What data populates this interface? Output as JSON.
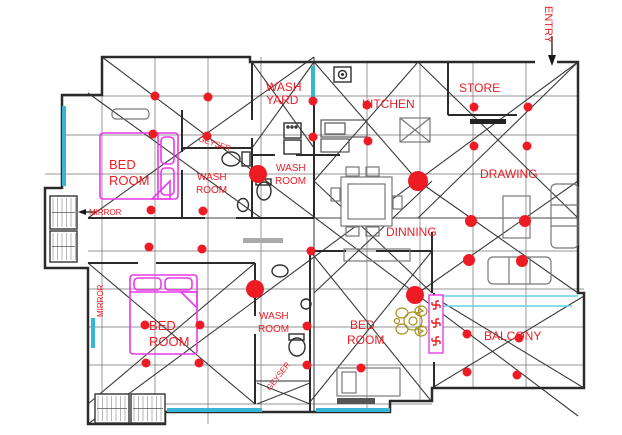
{
  "canvas": {
    "width": 622,
    "height": 435,
    "background": "#ffffff"
  },
  "colors": {
    "label": "#ed1c24",
    "dot": "#ed1c24",
    "wall": "#2b2b2b",
    "grid": "#707070",
    "diagonal": "#3a3a3a",
    "window": "#35b6d6",
    "bed": "#e93ae9",
    "furniture": "#777777",
    "fixture": "#2f2f2f",
    "ornament": "#a8921f",
    "swastika": "#ed1c24",
    "swastika_box": "#e93ae9"
  },
  "labels": [
    {
      "id": "entry",
      "text": "ENTRY",
      "x": 545,
      "y": 6,
      "size": 11,
      "rotate": 90
    },
    {
      "id": "wash-yard-1",
      "text": "WASH",
      "x": 266,
      "y": 91,
      "size": 12,
      "rotate": 0
    },
    {
      "id": "wash-yard-2",
      "text": "YARD",
      "x": 266,
      "y": 104,
      "size": 12,
      "rotate": 0
    },
    {
      "id": "kitchen",
      "text": "KITCHEN",
      "x": 362,
      "y": 108,
      "size": 12,
      "rotate": 0
    },
    {
      "id": "store",
      "text": "STORE",
      "x": 459,
      "y": 92,
      "size": 12,
      "rotate": 0
    },
    {
      "id": "drawing",
      "text": "DRAWING",
      "x": 480,
      "y": 178,
      "size": 12,
      "rotate": 0
    },
    {
      "id": "dinning",
      "text": "DINNING",
      "x": 386,
      "y": 236,
      "size": 12,
      "rotate": 0
    },
    {
      "id": "balcony",
      "text": "BALCONY",
      "x": 484,
      "y": 340,
      "size": 12,
      "rotate": 0
    },
    {
      "id": "bed-room-1a",
      "text": "BED",
      "x": 109,
      "y": 169,
      "size": 13,
      "rotate": 0
    },
    {
      "id": "bed-room-1b",
      "text": "ROOM",
      "x": 109,
      "y": 185,
      "size": 13,
      "rotate": 0
    },
    {
      "id": "bed-room-2a",
      "text": "BED",
      "x": 149,
      "y": 330,
      "size": 13,
      "rotate": 0
    },
    {
      "id": "bed-room-2b",
      "text": "ROOM",
      "x": 149,
      "y": 346,
      "size": 13,
      "rotate": 0
    },
    {
      "id": "bed-room-3a",
      "text": "BED",
      "x": 350,
      "y": 329,
      "size": 12,
      "rotate": 0
    },
    {
      "id": "bed-room-3b",
      "text": "ROOM",
      "x": 347,
      "y": 344,
      "size": 12,
      "rotate": 0
    },
    {
      "id": "wash-room-1a",
      "text": "WASH",
      "x": 197,
      "y": 180,
      "size": 10,
      "rotate": 0
    },
    {
      "id": "wash-room-1b",
      "text": "ROOM",
      "x": 196,
      "y": 193,
      "size": 10,
      "rotate": 0
    },
    {
      "id": "wash-room-2a",
      "text": "WASH",
      "x": 276,
      "y": 171,
      "size": 10,
      "rotate": 0
    },
    {
      "id": "wash-room-2b",
      "text": "ROOM",
      "x": 275,
      "y": 184,
      "size": 10,
      "rotate": 0
    },
    {
      "id": "wash-room-3a",
      "text": "WASH",
      "x": 259,
      "y": 319,
      "size": 10,
      "rotate": 0
    },
    {
      "id": "wash-room-3b",
      "text": "ROOM",
      "x": 258,
      "y": 332,
      "size": 10,
      "rotate": 0
    },
    {
      "id": "geyser-1",
      "text": "GEYSER",
      "x": 198,
      "y": 141,
      "size": 8,
      "rotate": 18
    },
    {
      "id": "geyser-2",
      "text": "GEYSER",
      "x": 270,
      "y": 391,
      "size": 8,
      "rotate": -52
    },
    {
      "id": "mirror-1",
      "text": "MIRROR",
      "x": 89,
      "y": 215,
      "size": 8,
      "rotate": 0
    },
    {
      "id": "mirror-2",
      "text": "MIRROR",
      "x": 103,
      "y": 317,
      "size": 8,
      "rotate": -90
    }
  ],
  "dots": [
    [
      155,
      96
    ],
    [
      208,
      97
    ],
    [
      313,
      101
    ],
    [
      367,
      105
    ],
    [
      474,
      107
    ],
    [
      528,
      107
    ],
    [
      153,
      134
    ],
    [
      207,
      136
    ],
    [
      313,
      137
    ],
    [
      368,
      141
    ],
    [
      474,
      146
    ],
    [
      527,
      146
    ],
    [
      258,
      174,
      9
    ],
    [
      418,
      181,
      10
    ],
    [
      151,
      210
    ],
    [
      203,
      211
    ],
    [
      471,
      221,
      6
    ],
    [
      525,
      221,
      6
    ],
    [
      149,
      247
    ],
    [
      202,
      249
    ],
    [
      311,
      251
    ],
    [
      469,
      260,
      6
    ],
    [
      522,
      261,
      6
    ],
    [
      255,
      289,
      9
    ],
    [
      415,
      295,
      9
    ],
    [
      145,
      325
    ],
    [
      200,
      325
    ],
    [
      307,
      326
    ],
    [
      467,
      334
    ],
    [
      519,
      338
    ],
    [
      146,
      363
    ],
    [
      199,
      363
    ],
    [
      307,
      365
    ],
    [
      361,
      368
    ],
    [
      467,
      372
    ],
    [
      517,
      375
    ]
  ],
  "swastikas": {
    "count": 3,
    "positions": [
      [
        436,
        305
      ],
      [
        436,
        323
      ],
      [
        436,
        341
      ]
    ]
  },
  "ornament": {
    "x": 413,
    "y": 321
  }
}
